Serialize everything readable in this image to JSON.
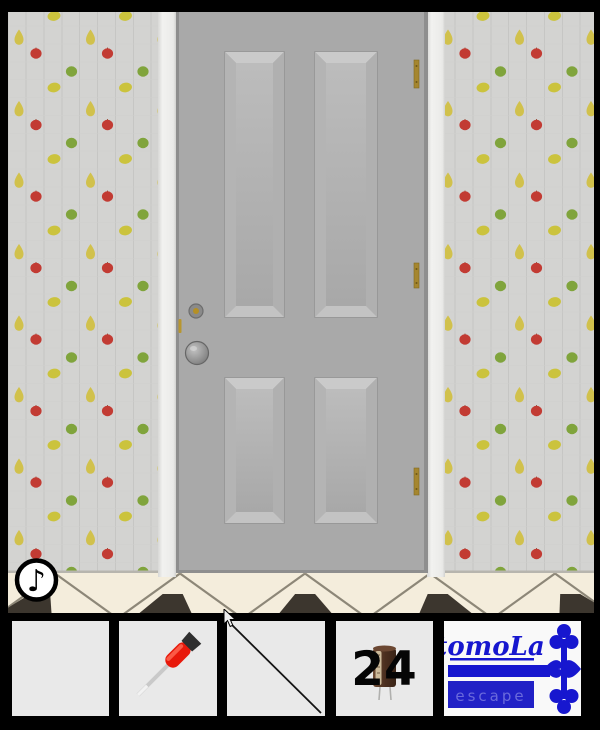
{
  "app": {
    "title": "tomoLa escape - room"
  },
  "scene": {
    "music_button": {
      "glyph": "♪",
      "name": "music toggle button"
    },
    "door": {
      "panels": 4,
      "hinges": 3,
      "knob": "round gray knob",
      "keyhole": "gold keyhole"
    },
    "wallpaper_fruits": [
      "lemon",
      "pear",
      "red apple",
      "green apple"
    ]
  },
  "inventory": {
    "slots": [
      {
        "item": "empty"
      },
      {
        "item": "screwdriver"
      },
      {
        "item": "thin metal rod"
      },
      {
        "item": "capacitor",
        "label": "24"
      },
      {
        "item": "logo",
        "title": "tomoLa",
        "subtitle": "escape"
      }
    ]
  },
  "colors": {
    "wallpaper": "#d3d3d1",
    "fruit_red": "#c23b33",
    "fruit_green": "#80a43c",
    "fruit_lemon": "#cbc33d",
    "fruit_pear": "#d1c14c",
    "door_face": "#a9a9a9",
    "door_frame": "#8e8e8e",
    "trim": "#efefed",
    "hinge_gold": "#a5862f",
    "floor": "#f4eddc",
    "floor_tile_dark": "#3c362e",
    "logo_blue": "#1717cf",
    "screwdriver_red": "#e8190b"
  }
}
